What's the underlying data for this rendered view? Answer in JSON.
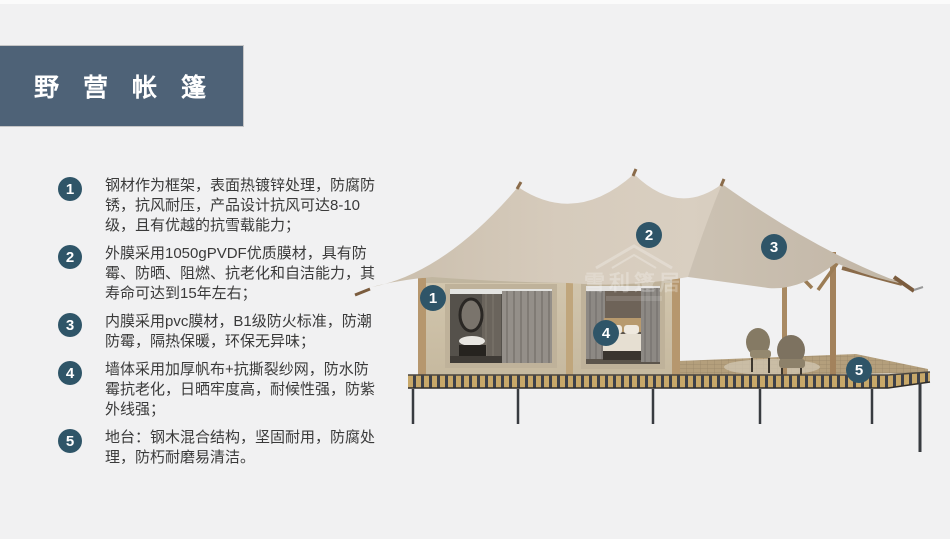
{
  "header": {
    "title": "野营帐篷"
  },
  "features": [
    {
      "num": "1",
      "text": "钢材作为框架，表面热镀锌处理，防腐防锈，抗风耐压，产品设计抗风可达8-10级，且有优越的抗雪载能力；"
    },
    {
      "num": "2",
      "text": "外膜采用1050gPVDF优质膜材，具有防霉、防晒、阻燃、抗老化和自洁能力，其寿命可达到15年左右；"
    },
    {
      "num": "3",
      "text": "内膜采用pvc膜材，B1级防火标准，防潮防霉，隔热保暖，环保无异味；"
    },
    {
      "num": "4",
      "text": "墙体采用加厚帆布+抗撕裂纱网，防水防霉抗老化，日晒牢度高，耐候性强，防紫外线强；"
    },
    {
      "num": "5",
      "text": "地台：钢木混合结构，坚固耐用，防腐处理，防朽耐磨易清洁。"
    }
  ],
  "image_markers": [
    {
      "num": "1"
    },
    {
      "num": "2"
    },
    {
      "num": "3"
    },
    {
      "num": "4"
    },
    {
      "num": "5"
    }
  ],
  "watermark": {
    "text": "雪利篷居"
  },
  "colors": {
    "background": "#f1f1f2",
    "banner_bg": "#4e6277",
    "badge_bg": "#2f5568",
    "body_text": "#3a3a3a",
    "roof_fabric": "#d3c8b8",
    "cabin_wall": "#cdc1a9",
    "deck_plank": "#c8a869",
    "platform_leg": "#383b40"
  }
}
